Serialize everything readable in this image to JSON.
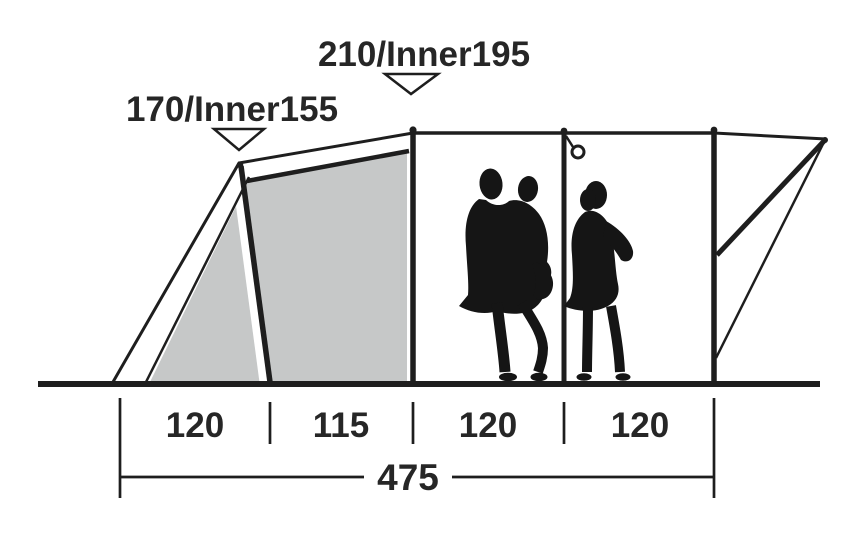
{
  "labels": {
    "front_height": "170/Inner155",
    "main_height": "210/Inner195"
  },
  "dimensions": {
    "segments": [
      {
        "label": "120"
      },
      {
        "label": "115"
      },
      {
        "label": "120"
      },
      {
        "label": "120"
      }
    ],
    "total": "475"
  },
  "figures": {
    "left": "adult-with-child-silhouette",
    "right": "woman-silhouette"
  },
  "colors": {
    "line": "#1e1e1e",
    "panel": "#c6c8c8",
    "silhouette": "#151515",
    "text": "#262626",
    "background": "#ffffff"
  }
}
